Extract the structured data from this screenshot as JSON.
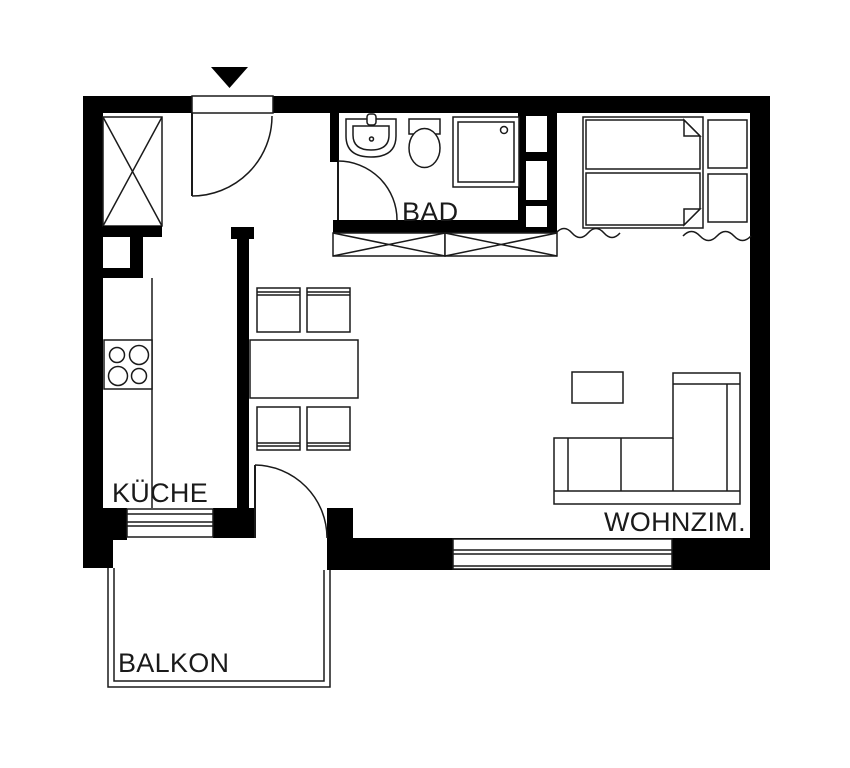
{
  "floorplan": {
    "type": "apartment-floor-plan",
    "rooms": {
      "bathroom": {
        "label": "BAD"
      },
      "kitchen": {
        "label": "KÜCHE"
      },
      "living_room": {
        "label": "WOHNZIM."
      },
      "balcony": {
        "label": "BALKON"
      }
    },
    "colors": {
      "wall": "#000000",
      "line": "#1a1a1a",
      "background": "#ffffff"
    },
    "furniture_icons": [
      "entrance-arrow-icon",
      "entrance-door-swing-icon",
      "wardrobe-icon",
      "shaft-icon",
      "kitchen-counter-icon",
      "stove-icon",
      "sink-icon",
      "toilet-icon",
      "shower-icon",
      "bathroom-door-swing-icon",
      "hall-cabinet-icon",
      "wall-niche-shelf-icon",
      "double-bed-icon",
      "nightstand-icon",
      "break-line-icon",
      "dining-table-icon",
      "dining-chair-icon",
      "coffee-table-icon",
      "corner-sofa-icon",
      "kitchen-window-icon",
      "living-room-window-icon",
      "balcony-door-swing-icon",
      "balcony-railing-icon"
    ]
  }
}
